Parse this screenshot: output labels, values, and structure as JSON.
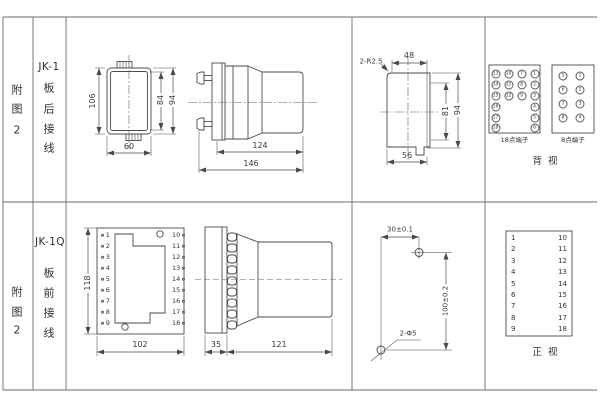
{
  "row1": {
    "figure": [
      "附",
      "图",
      "2"
    ],
    "model": "JK-1",
    "wiring": [
      "板",
      "后",
      "接",
      "线"
    ],
    "dims": {
      "outer_height": "106",
      "inner_height": "84",
      "mid_height": "94",
      "width": "60",
      "body_length": "124",
      "total_length": "146",
      "corner_radius": "2-R2.5",
      "top_width": "48",
      "cutout_inner_height": "81",
      "cutout_height": "94",
      "cutout_width": "56"
    },
    "terminals18": {
      "title": "18点端子",
      "grid": [
        [
          "13",
          "10",
          "7",
          "1"
        ],
        [
          "14",
          "11",
          "8",
          "2"
        ],
        [
          "15",
          "12",
          "9",
          "3"
        ],
        [
          "16",
          "",
          "",
          "4"
        ],
        [
          "17",
          "",
          "",
          "5"
        ],
        [
          "18",
          "",
          "",
          "6"
        ]
      ]
    },
    "terminals8": {
      "title": "8点端子",
      "grid": [
        [
          "5",
          "1"
        ],
        [
          "6",
          "2"
        ],
        [
          "7",
          "3"
        ],
        [
          "8",
          "4"
        ]
      ]
    },
    "view_label": "背  视"
  },
  "row2": {
    "figure": [
      "附",
      "图",
      "2"
    ],
    "model": "JK-1Q",
    "wiring": [
      "板",
      "前",
      "接",
      "线"
    ],
    "dims": {
      "height": "118",
      "width": "102",
      "plate_thickness": "35",
      "body_length": "121",
      "hole_h_offset": "30±0.1",
      "hole_v_offset": "100±0.2",
      "hole_spec": "2-Φ5"
    },
    "plate_terminals": {
      "left": [
        "1",
        "2",
        "3",
        "4",
        "5",
        "6",
        "7",
        "8",
        "9"
      ],
      "right": [
        "10",
        "11",
        "12",
        "13",
        "14",
        "15",
        "16",
        "17",
        "18"
      ]
    },
    "terminal_table": {
      "left": [
        "1",
        "2",
        "3",
        "4",
        "5",
        "6",
        "7",
        "8",
        "9"
      ],
      "right": [
        "10",
        "11",
        "12",
        "13",
        "14",
        "15",
        "16",
        "17",
        "18"
      ]
    },
    "view_label": "正  视"
  }
}
